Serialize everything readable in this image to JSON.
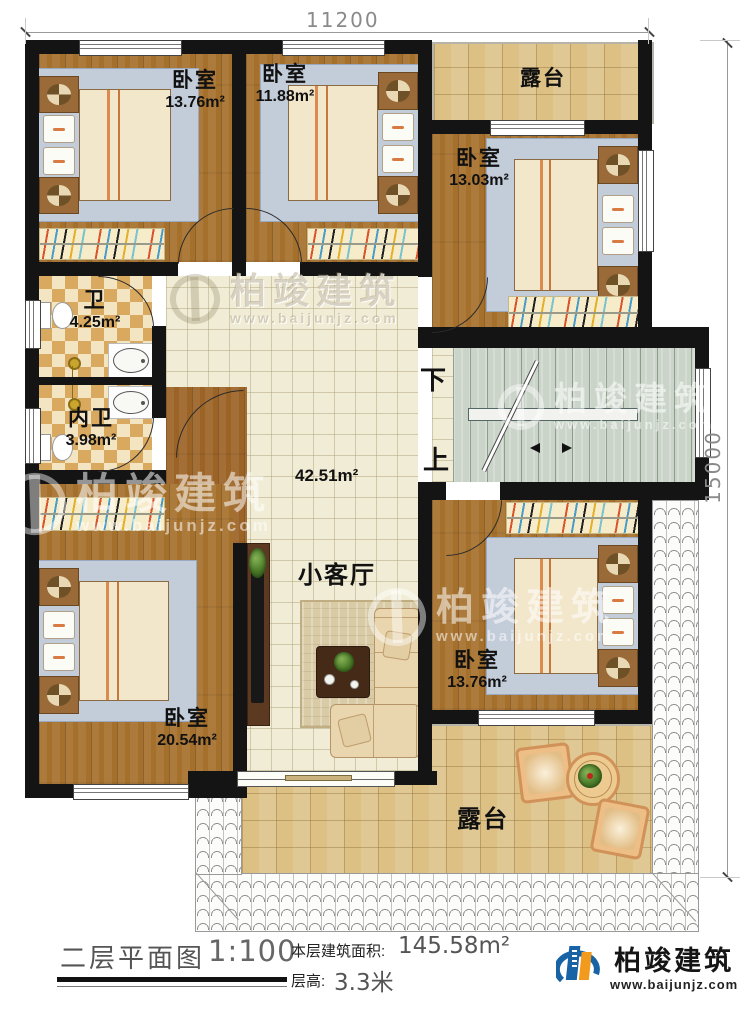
{
  "dimensions": {
    "width_label": "11200",
    "height_label": "15000"
  },
  "rooms": {
    "bedroom_top_left": {
      "name": "卧室",
      "area": "13.76m²"
    },
    "bedroom_top_middle": {
      "name": "卧室",
      "area": "11.88m²"
    },
    "terrace_top": {
      "name": "露台"
    },
    "bedroom_right": {
      "name": "卧室",
      "area": "13.03m²"
    },
    "bathroom": {
      "name": "卫",
      "area": "4.25m²"
    },
    "ensuite_bathroom": {
      "name": "内卫",
      "area": "3.98m²"
    },
    "hall": {
      "area": "42.51m²"
    },
    "living_room": {
      "name": "小客厅"
    },
    "bedroom_bottom_left": {
      "name": "卧室",
      "area": "20.54m²"
    },
    "bedroom_bottom_right": {
      "name": "卧室",
      "area": "13.76m²"
    },
    "terrace_bottom": {
      "name": "露台"
    }
  },
  "stairs": {
    "down_label": "下",
    "up_label": "上"
  },
  "title_block": {
    "plan_title": "二层平面图",
    "scale": "1:100",
    "floor_area_label": "本层建筑面积:",
    "floor_area_value": "145.58m²",
    "floor_height_label": "层高:",
    "floor_height_value": "3.3米"
  },
  "logo": {
    "company": "柏竣建筑",
    "website": "www.baijunjz.com"
  },
  "watermark": {
    "company": "柏竣建筑",
    "website": "www.baijunjz.com"
  },
  "colors": {
    "wall": "#141414",
    "wood": "#a5702c",
    "tile": "#f1ecd6",
    "terrace": "#dcc084",
    "stairs": "#cad4c8",
    "accent": "#d9542c",
    "logo_blue": "#1763a6",
    "logo_orange": "#f29a1d"
  }
}
